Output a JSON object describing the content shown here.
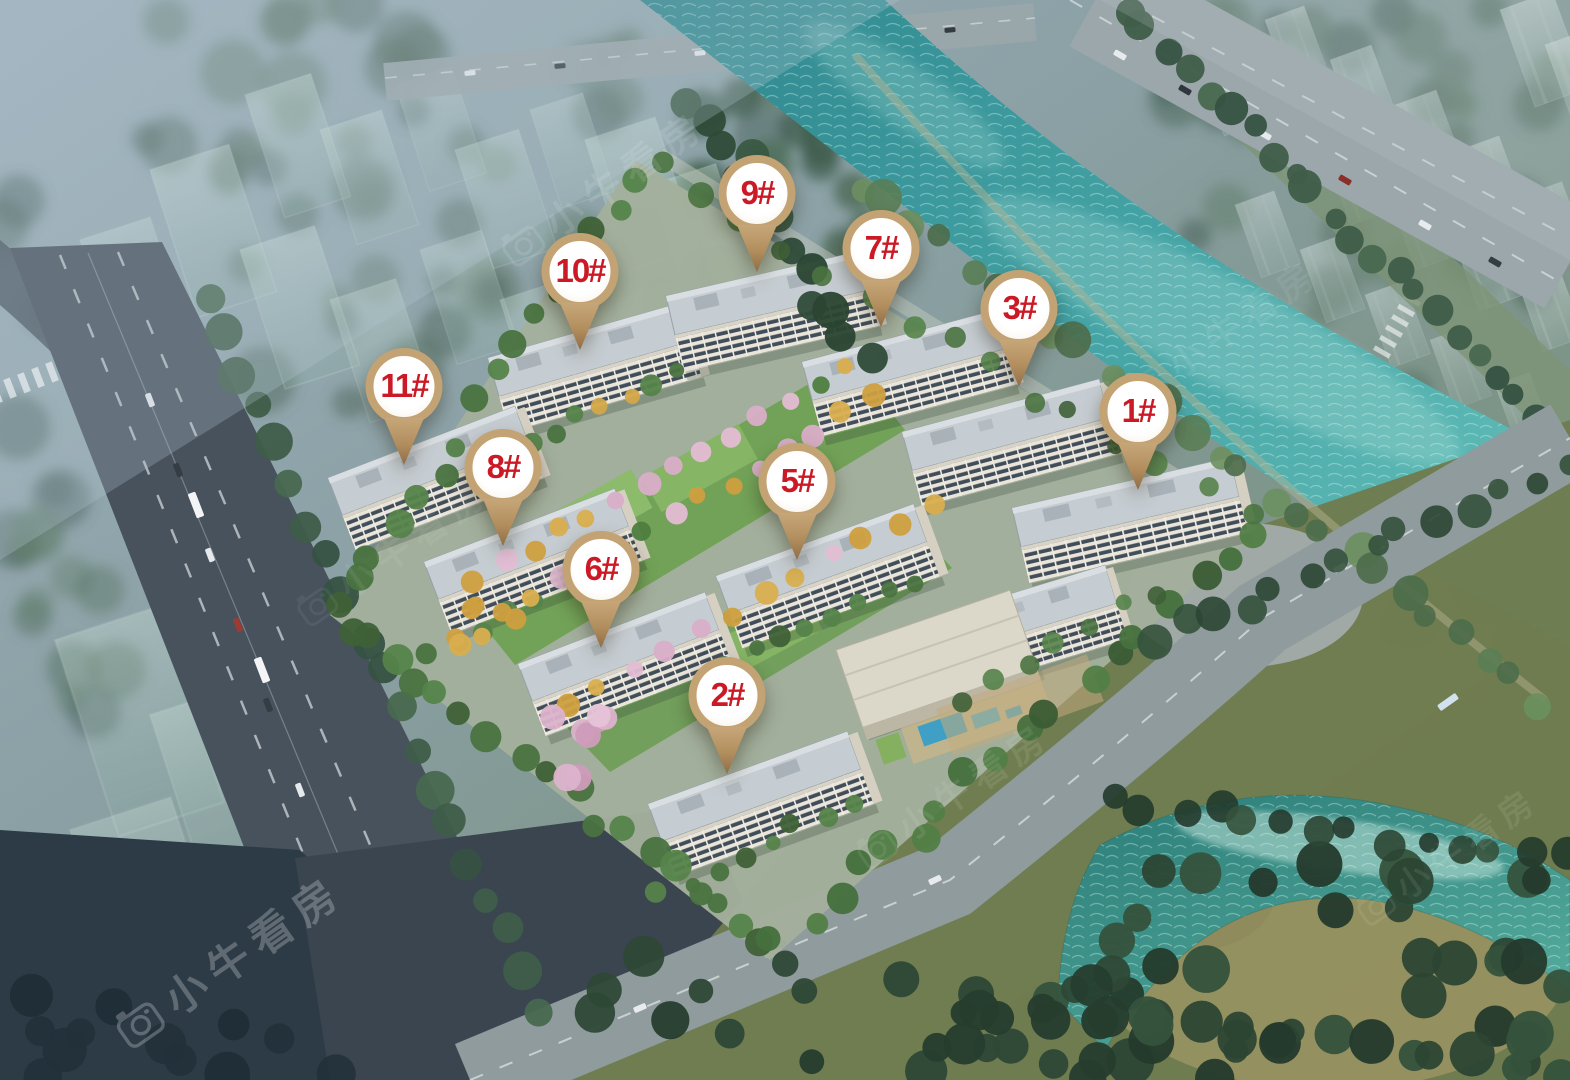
{
  "title": "residential-compound-aerial-rendering",
  "markers": [
    {
      "id": "1",
      "label": "1#",
      "x": 1138,
      "y": 490
    },
    {
      "id": "2",
      "label": "2#",
      "x": 727,
      "y": 774
    },
    {
      "id": "3",
      "label": "3#",
      "x": 1019,
      "y": 387
    },
    {
      "id": "5",
      "label": "5#",
      "x": 797,
      "y": 560
    },
    {
      "id": "6",
      "label": "6#",
      "x": 601,
      "y": 648
    },
    {
      "id": "7",
      "label": "7#",
      "x": 881,
      "y": 327
    },
    {
      "id": "8",
      "label": "8#",
      "x": 503,
      "y": 546
    },
    {
      "id": "9",
      "label": "9#",
      "x": 757,
      "y": 272
    },
    {
      "id": "10",
      "label": "10#",
      "x": 580,
      "y": 350
    },
    {
      "id": "11",
      "label": "11#",
      "x": 404,
      "y": 465
    }
  ],
  "watermark": {
    "text": "小牛看房",
    "icon": "camera-icon"
  },
  "colors": {
    "marker_ring": "#c3a273",
    "marker_tail": "#b28e5e",
    "marker_text": "#cb1a26",
    "river_teal": "#3d9aa0",
    "pond_teal": "#2f8b84",
    "building_wall": "#eae5da",
    "window_band": "#414e5a"
  }
}
